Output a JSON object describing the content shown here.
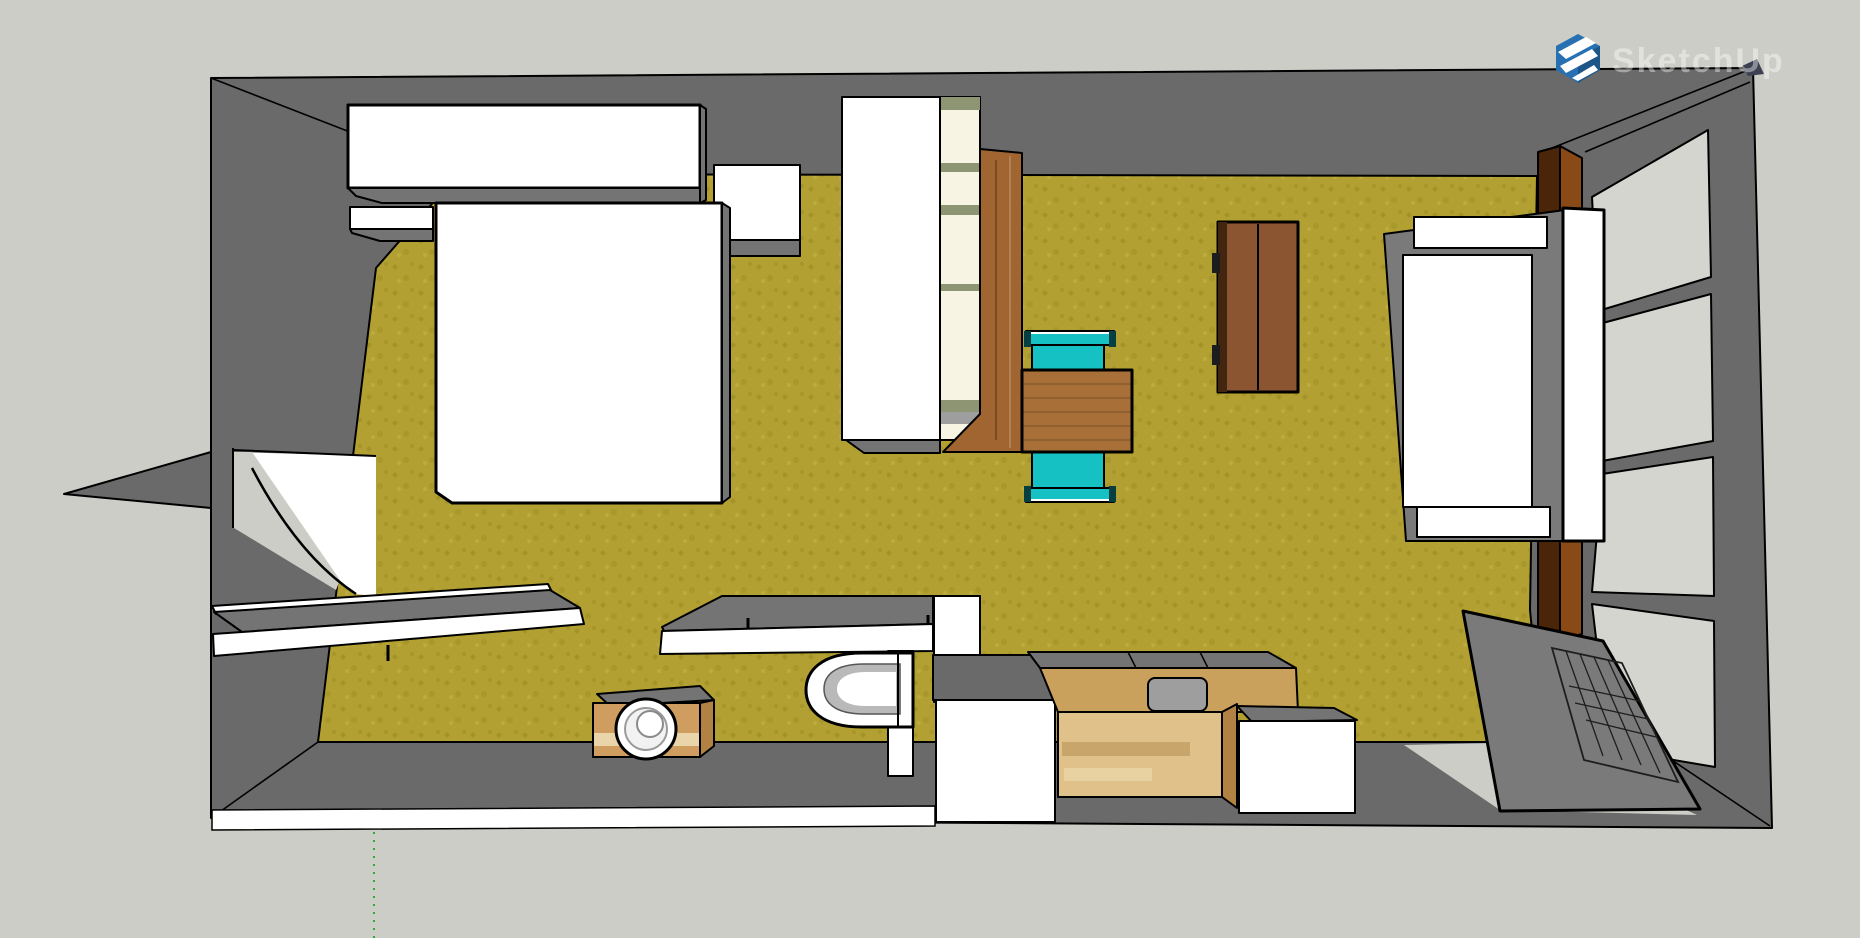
{
  "app": {
    "watermark_text": "SketchUp",
    "logo": {
      "name": "sketchup-cube-logo",
      "color": "#2770b1"
    }
  },
  "colors": {
    "canvas": "#cdcdc7",
    "wall": "#6a6a6a",
    "top_face": "#747474",
    "floor": "#b2a132",
    "floor_speckle": "#93841f",
    "white": "#ffffff",
    "pane": "#d4d5cf",
    "frame_gray": "#7a7a7a",
    "metal": "#9e9e9e",
    "teal": "#16c1c4",
    "teal_dark": "#0b8184",
    "table_wood": "#a86f38",
    "panel_wood": "#a06530",
    "dresser_wood": "#8a5530",
    "dresser_edge": "#42260f",
    "counter_top": "#c9a05c",
    "counter_front": "#e0c189",
    "counter_side": "#b28245",
    "speaker_wood": "#cf9d5f",
    "speaker_band": "#ead5ab",
    "shelf_cream": "#f7f4e3",
    "shelf_olive": "#8e9572",
    "post_dark": "#4a2507",
    "post_light": "#8a4a15",
    "toilet_inner": "#b9b9b9",
    "corner_navy": "#3c4252",
    "axis_green": "#3aa33a",
    "watermark_fill": "rgba(255,255,255,0.40)",
    "logo_blue": "#2770b1",
    "logo_blue_dark": "#1c5588"
  }
}
